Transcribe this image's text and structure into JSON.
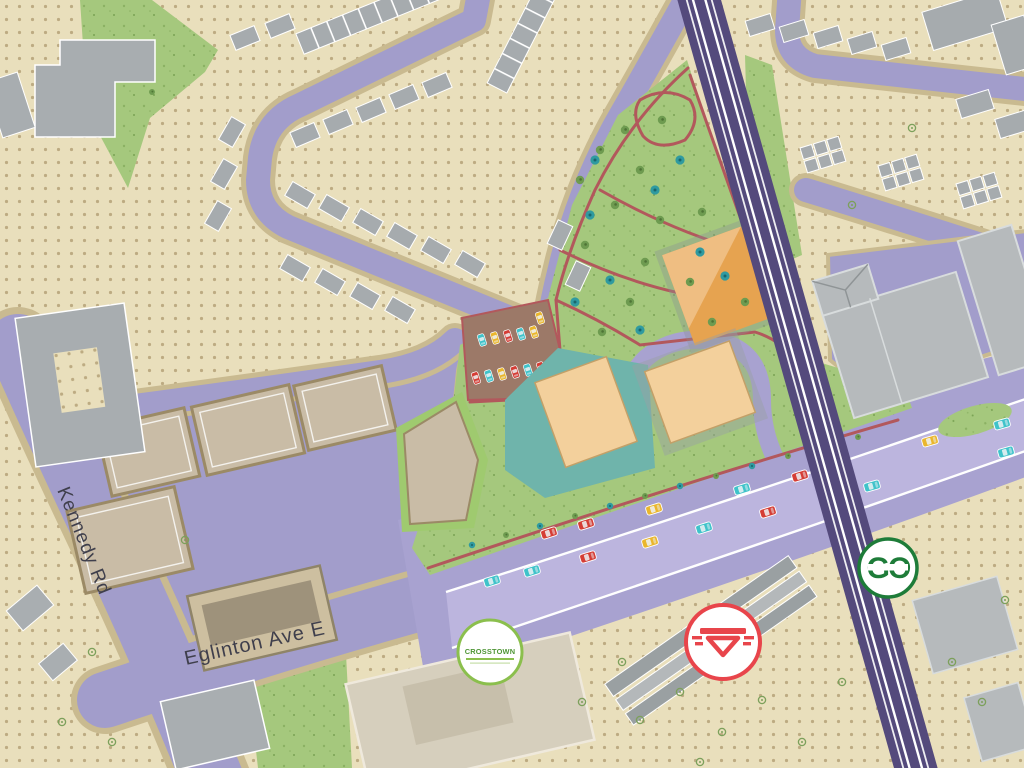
{
  "scene": {
    "title": "Stylized neighbourhood transit map",
    "description": "Illustrated plan view of the Kennedy Rd / Eglinton Ave E area with rail corridor, central park and transit station badges"
  },
  "roads": {
    "kennedy_label": "Kennedy Rd",
    "eglinton_label": "Eglinton Ave E"
  },
  "badges": {
    "go": {
      "label": "GO",
      "color": "#1e7c39",
      "name": "go-transit-badge"
    },
    "ttc": {
      "name": "ttc-roundel-badge",
      "color": "#e8454b"
    },
    "crosstown": {
      "label": "CROSSTOWN",
      "color": "#64a73c",
      "name": "crosstown-lrt-badge"
    }
  },
  "palette": {
    "ground": "#e9dfbc",
    "ground_dot": "#b5a278",
    "road": "#a29dcb",
    "road_light": "#bcb5de",
    "sidewalk": "#c9ba90",
    "rail": "#544a7c",
    "park": "#a5c87d",
    "pond": "#6fb4ab",
    "building_gray": "#a9aeb1",
    "building_taupe": "#c9bca6",
    "building_orange": "#e6a350",
    "building_sand": "#f3d09c",
    "parking_lot_brown": "#9c7968",
    "path_red": "#b2585c",
    "car_red": "#d53d35",
    "car_teal": "#3fc3ca",
    "car_yellow": "#eab62c",
    "tree_green": "#6e9b50",
    "tree_teal": "#2f9aa0",
    "label": "#3f3f4c"
  }
}
